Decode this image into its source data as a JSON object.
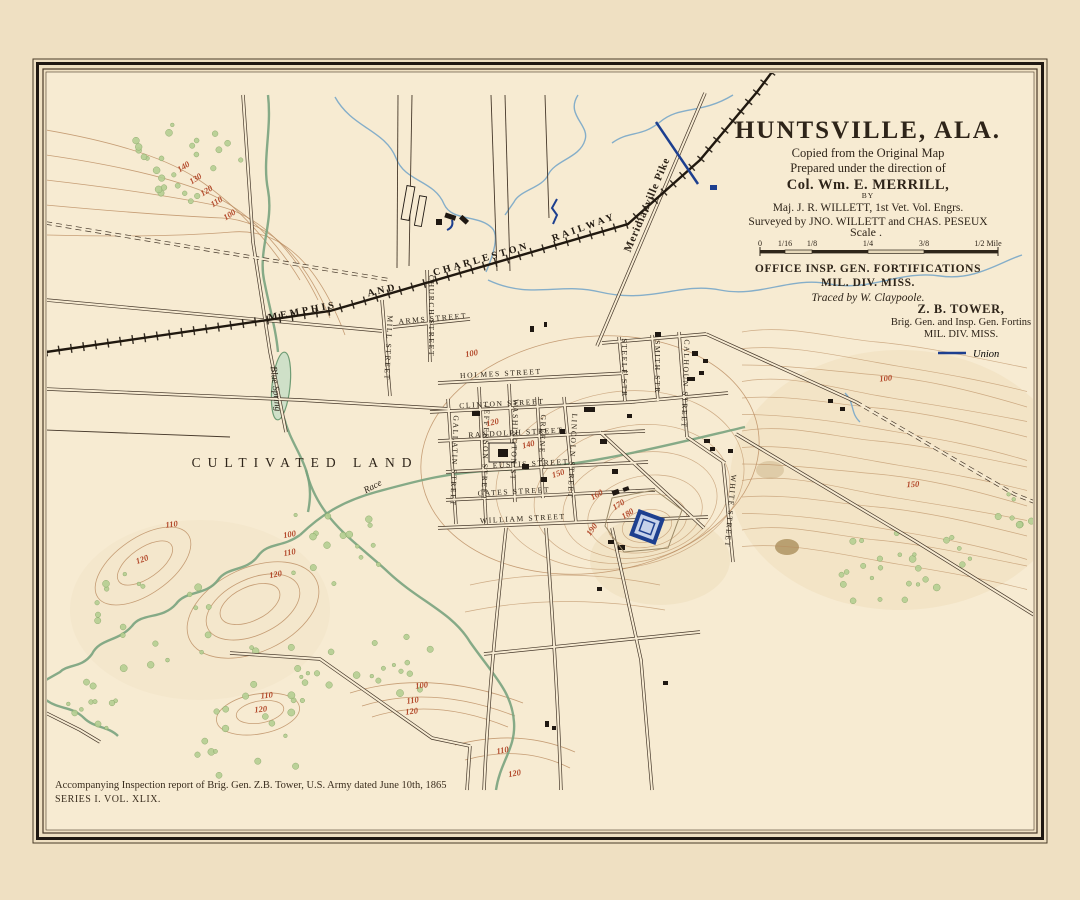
{
  "colors": {
    "paper": "#efe0c2",
    "map_background": "#f7ebd2",
    "contour_label": "#b3492b",
    "union_blue": "#1d3f8f",
    "stream_green": "#79a37e",
    "stream_blue": "#85aec9",
    "ink": "#2e2419"
  },
  "title_block": {
    "title": "HUNTSVILLE, ALA.",
    "line1": "Copied from the Original Map",
    "line2": "Prepared under the direction of",
    "director": "Col. Wm. E. MERRILL,",
    "by_word": "BY",
    "author": "Maj. J. R. WILLETT, 1st Vet. Vol. Engrs.",
    "surveyors": "Surveyed by JNO. WILLETT and CHAS. PESEUX",
    "scale_word": "Scale .",
    "scale_ticks": [
      "0",
      "1/16",
      "1/8",
      "1/4",
      "3/8",
      "1/2 Mile"
    ],
    "office_line1": "OFFICE INSP. GEN. FORTIFICATIONS",
    "office_line2": "MIL. DIV. MISS.",
    "traced": "Traced by W. Claypoole.",
    "sign_name": "Z. B. TOWER,",
    "sign_rank": "Brig. Gen. and Insp. Gen. Fortins",
    "sign_division": "MIL. DIV. MISS.",
    "union_label": "Union"
  },
  "footer": {
    "line1": "Accompanying Inspection report of Brig. Gen. Z.B. Tower, U.S. Army dated June 10th, 1865",
    "line2": "SERIES I. VOL. XLIX."
  },
  "labels": [
    {
      "text": "MEMPHIS",
      "x": 303,
      "y": 314,
      "r": -11,
      "cls": "rail"
    },
    {
      "text": "AND",
      "x": 383,
      "y": 293,
      "r": -13,
      "cls": "rail"
    },
    {
      "text": "CHARLESTON",
      "x": 482,
      "y": 262,
      "r": -16,
      "cls": "rail"
    },
    {
      "text": "RAILWAY",
      "x": 585,
      "y": 230,
      "r": -20,
      "cls": "rail"
    },
    {
      "text": "Meridianville Pike",
      "x": 650,
      "y": 206,
      "r": -67,
      "cls": "pike"
    },
    {
      "text": "CULTIVATED  LAND",
      "x": 305,
      "y": 467,
      "r": 0,
      "cls": "big"
    },
    {
      "text": "Blue Spring",
      "x": 273,
      "y": 389,
      "r": 84,
      "cls": "water"
    },
    {
      "text": "Race",
      "x": 374,
      "y": 489,
      "r": -28,
      "cls": "water"
    },
    {
      "text": "ARMS STREET",
      "x": 433,
      "y": 321,
      "r": -5,
      "cls": "street"
    },
    {
      "text": "HOLMES STREET",
      "x": 501,
      "y": 376,
      "r": -3,
      "cls": "street"
    },
    {
      "text": "CLINTON STREET",
      "x": 502,
      "y": 406,
      "r": -3,
      "cls": "street"
    },
    {
      "text": "RANDOLPH STREET",
      "x": 516,
      "y": 435,
      "r": -3,
      "cls": "street"
    },
    {
      "text": "EUSTIS STREET",
      "x": 531,
      "y": 466,
      "r": -3,
      "cls": "street"
    },
    {
      "text": "GATES STREET",
      "x": 514,
      "y": 494,
      "r": -3,
      "cls": "street"
    },
    {
      "text": "WILLIAM  STREET",
      "x": 523,
      "y": 521,
      "r": -3,
      "cls": "street"
    },
    {
      "text": "MILL STREET",
      "x": 386,
      "y": 348,
      "r": 93,
      "cls": "street"
    },
    {
      "text": "CHURCH STREET",
      "x": 429,
      "y": 316,
      "r": 90,
      "cls": "street"
    },
    {
      "text": "GALLATIN STREET",
      "x": 452,
      "y": 461,
      "r": 92,
      "cls": "street"
    },
    {
      "text": "JEFFERSON STREET",
      "x": 483,
      "y": 453,
      "r": 92,
      "cls": "street"
    },
    {
      "text": "WASHINGTON ST",
      "x": 512,
      "y": 440,
      "r": 92,
      "cls": "street"
    },
    {
      "text": "GREENE ST",
      "x": 540,
      "y": 442,
      "r": 92,
      "cls": "street"
    },
    {
      "text": "LINCOLN STREET",
      "x": 570,
      "y": 456,
      "r": 93,
      "cls": "street"
    },
    {
      "text": "STEELE STR",
      "x": 622,
      "y": 368,
      "r": 90,
      "cls": "street"
    },
    {
      "text": "SMITH STR",
      "x": 655,
      "y": 367,
      "r": 90,
      "cls": "street"
    },
    {
      "text": "CALHOUN STREET",
      "x": 683,
      "y": 384,
      "r": 92,
      "cls": "street"
    },
    {
      "text": "WHITE STREET",
      "x": 728,
      "y": 511,
      "r": 95,
      "cls": "street"
    }
  ],
  "contour_labels": [
    {
      "value": "140",
      "x": 185,
      "y": 169,
      "r": -33
    },
    {
      "value": "130",
      "x": 197,
      "y": 181,
      "r": -33
    },
    {
      "value": "120",
      "x": 208,
      "y": 193,
      "r": -33
    },
    {
      "value": "110",
      "x": 218,
      "y": 204,
      "r": -33
    },
    {
      "value": "100",
      "x": 231,
      "y": 217,
      "r": -33
    },
    {
      "value": "100",
      "x": 472,
      "y": 356,
      "r": -10
    },
    {
      "value": "120",
      "x": 493,
      "y": 425,
      "r": -12
    },
    {
      "value": "140",
      "x": 529,
      "y": 447,
      "r": -15
    },
    {
      "value": "150",
      "x": 559,
      "y": 476,
      "r": -18
    },
    {
      "value": "160",
      "x": 598,
      "y": 497,
      "r": -30
    },
    {
      "value": "170",
      "x": 620,
      "y": 507,
      "r": -32
    },
    {
      "value": "180",
      "x": 629,
      "y": 516,
      "r": -32
    },
    {
      "value": "190",
      "x": 594,
      "y": 531,
      "r": -55
    },
    {
      "value": "100",
      "x": 886,
      "y": 381,
      "r": -6
    },
    {
      "value": "150",
      "x": 913,
      "y": 487,
      "r": -2
    },
    {
      "value": "110",
      "x": 172,
      "y": 527,
      "r": -8
    },
    {
      "value": "120",
      "x": 143,
      "y": 562,
      "r": -20
    },
    {
      "value": "100",
      "x": 290,
      "y": 537,
      "r": -10
    },
    {
      "value": "110",
      "x": 290,
      "y": 555,
      "r": -10
    },
    {
      "value": "120",
      "x": 276,
      "y": 577,
      "r": -10
    },
    {
      "value": "110",
      "x": 267,
      "y": 698,
      "r": -6
    },
    {
      "value": "120",
      "x": 261,
      "y": 712,
      "r": -6
    },
    {
      "value": "100",
      "x": 422,
      "y": 688,
      "r": -8
    },
    {
      "value": "110",
      "x": 413,
      "y": 703,
      "r": -8
    },
    {
      "value": "120",
      "x": 412,
      "y": 714,
      "r": -8
    },
    {
      "value": "110",
      "x": 503,
      "y": 753,
      "r": -10
    },
    {
      "value": "120",
      "x": 515,
      "y": 776,
      "r": -10
    }
  ]
}
